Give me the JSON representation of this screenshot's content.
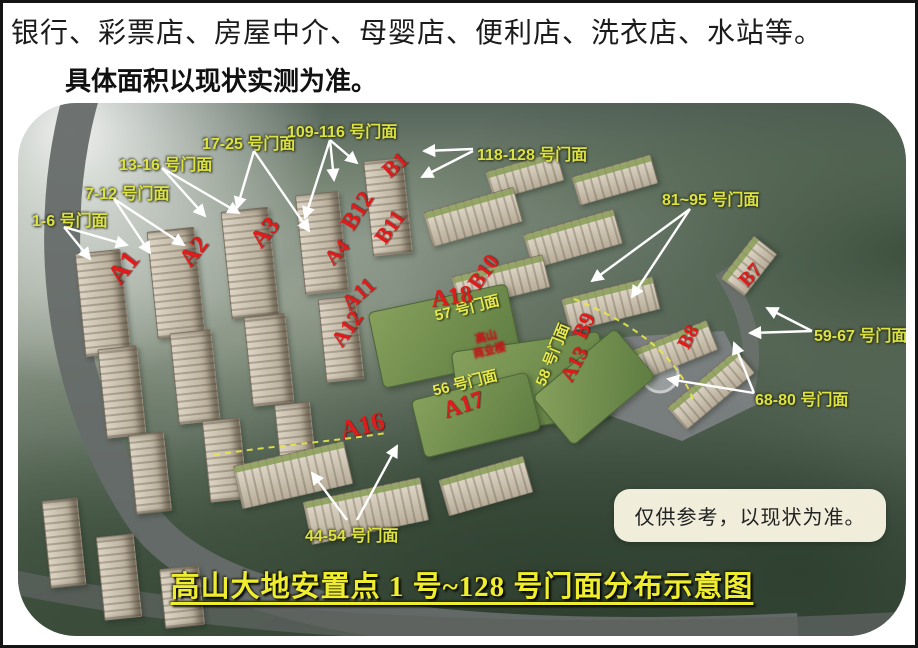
{
  "header": {
    "line1": "银行、彩票店、房屋中介、母婴店、便利店、洗衣店、水站等。",
    "line2": "具体面积以现状实测为准。"
  },
  "map": {
    "title": "高山大地安置点 1 号~128 号门面分布示意图",
    "note": "仅供参考，以现状为准。",
    "center_building_label": {
      "line1": "高山",
      "line2": "商业楼"
    },
    "shopfront_callouts": [
      {
        "text": "1-6 号门面",
        "x": 14,
        "y": 104
      },
      {
        "text": "7-12 号门面",
        "x": 67,
        "y": 77
      },
      {
        "text": "13-16 号门面",
        "x": 101,
        "y": 48
      },
      {
        "text": "17-25 号门面",
        "x": 184,
        "y": 27
      },
      {
        "text": "109-116 号门面",
        "x": 269,
        "y": 15
      },
      {
        "text": "118-128 号门面",
        "x": 459,
        "y": 38
      },
      {
        "text": "81~95 号门面",
        "x": 644,
        "y": 83
      },
      {
        "text": "59-67 号门面",
        "x": 796,
        "y": 219
      },
      {
        "text": "68-80 号门面",
        "x": 737,
        "y": 283
      },
      {
        "text": "44-54 号门面",
        "x": 287,
        "y": 419
      }
    ],
    "shopfront_strip_labels": [
      {
        "text": "57 号门面",
        "x": 451,
        "y": 203,
        "rot": -14
      },
      {
        "text": "56 号门面",
        "x": 449,
        "y": 278,
        "rot": -14
      },
      {
        "text": "58 号门面",
        "x": 536,
        "y": 250,
        "rot": -68
      }
    ],
    "building_labels": [
      {
        "text": "A1",
        "x": 109,
        "y": 162,
        "rot": -52,
        "size": 27
      },
      {
        "text": "A2",
        "x": 181,
        "y": 147,
        "rot": -52,
        "size": 25
      },
      {
        "text": "A3",
        "x": 252,
        "y": 128,
        "rot": -50,
        "size": 25
      },
      {
        "text": "A4",
        "x": 326,
        "y": 147,
        "rot": -48,
        "size": 21
      },
      {
        "text": "A11",
        "x": 342,
        "y": 189,
        "rot": -42,
        "size": 22
      },
      {
        "text": "A12",
        "x": 330,
        "y": 224,
        "rot": -55,
        "size": 22
      },
      {
        "text": "A13",
        "x": 558,
        "y": 259,
        "rot": -62,
        "size": 21
      },
      {
        "text": "A16",
        "x": 342,
        "y": 321,
        "rot": -14,
        "size": 26
      },
      {
        "text": "A17",
        "x": 445,
        "y": 301,
        "rot": -18,
        "size": 24
      },
      {
        "text": "A18",
        "x": 433,
        "y": 193,
        "rot": -8,
        "size": 24
      },
      {
        "text": "B1",
        "x": 384,
        "y": 60,
        "rot": -42,
        "size": 22
      },
      {
        "text": "B7",
        "x": 741,
        "y": 171,
        "rot": -48,
        "size": 20
      },
      {
        "text": "B8",
        "x": 679,
        "y": 233,
        "rot": -62,
        "size": 20
      },
      {
        "text": "B9",
        "x": 573,
        "y": 221,
        "rot": -66,
        "size": 22
      },
      {
        "text": "B10",
        "x": 467,
        "y": 167,
        "rot": -55,
        "size": 22
      },
      {
        "text": "B11",
        "x": 374,
        "y": 122,
        "rot": -55,
        "size": 22
      },
      {
        "text": "B12",
        "x": 340,
        "y": 107,
        "rot": -58,
        "size": 24
      }
    ],
    "arrows": [
      {
        "x1": 46,
        "y1": 124,
        "x2": 72,
        "y2": 156
      },
      {
        "x1": 46,
        "y1": 124,
        "x2": 109,
        "y2": 142
      },
      {
        "x1": 96,
        "y1": 96,
        "x2": 132,
        "y2": 150
      },
      {
        "x1": 96,
        "y1": 96,
        "x2": 166,
        "y2": 142
      },
      {
        "x1": 144,
        "y1": 65,
        "x2": 187,
        "y2": 113
      },
      {
        "x1": 144,
        "y1": 65,
        "x2": 221,
        "y2": 110
      },
      {
        "x1": 236,
        "y1": 48,
        "x2": 219,
        "y2": 105
      },
      {
        "x1": 236,
        "y1": 48,
        "x2": 291,
        "y2": 128
      },
      {
        "x1": 312,
        "y1": 37,
        "x2": 316,
        "y2": 77
      },
      {
        "x1": 312,
        "y1": 37,
        "x2": 339,
        "y2": 60
      },
      {
        "x1": 312,
        "y1": 37,
        "x2": 287,
        "y2": 115
      },
      {
        "x1": 455,
        "y1": 46,
        "x2": 406,
        "y2": 48
      },
      {
        "x1": 455,
        "y1": 48,
        "x2": 404,
        "y2": 74
      },
      {
        "x1": 672,
        "y1": 106,
        "x2": 574,
        "y2": 178
      },
      {
        "x1": 672,
        "y1": 106,
        "x2": 614,
        "y2": 194
      },
      {
        "x1": 794,
        "y1": 228,
        "x2": 749,
        "y2": 205
      },
      {
        "x1": 794,
        "y1": 228,
        "x2": 732,
        "y2": 230
      },
      {
        "x1": 736,
        "y1": 290,
        "x2": 716,
        "y2": 240
      },
      {
        "x1": 736,
        "y1": 290,
        "x2": 650,
        "y2": 276
      },
      {
        "x1": 329,
        "y1": 417,
        "x2": 294,
        "y2": 370
      },
      {
        "x1": 339,
        "y1": 417,
        "x2": 379,
        "y2": 343
      }
    ],
    "colors": {
      "callout_yellow": "#dce242",
      "title_yellow": "#efed2f",
      "building_red": "#e01b1b",
      "note_bg": "#f0eedb",
      "arrow_white": "#ffffff"
    }
  }
}
